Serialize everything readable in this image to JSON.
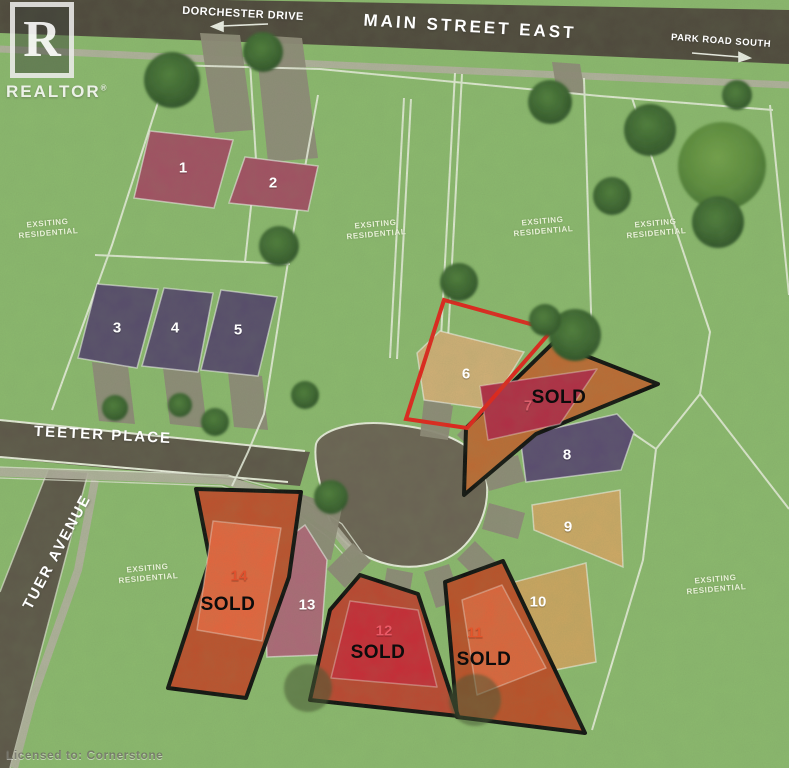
{
  "branding": {
    "logo_letter": "R",
    "logo_name": "REALTOR",
    "registered_symbol": "®",
    "license_watermark": "Licensed to: Cornerstone"
  },
  "streets": {
    "dorchester": {
      "label": "DORCHESTER DRIVE",
      "arrow": "left"
    },
    "main_street": {
      "label": "MAIN STREET EAST"
    },
    "park_road": {
      "label": "PARK ROAD SOUTH",
      "arrow": "right"
    },
    "teeter": {
      "label": "TEETER PLACE"
    },
    "tuer": {
      "label": "TUER AVENUE"
    }
  },
  "area_label": "EXSITING RESIDENTIAL",
  "map_colors": {
    "grass": "#8dbb6f",
    "main_road": "#4e463c",
    "local_road": "#5d5549",
    "cul_de_sac": "#6b6154",
    "sidewalk": "#b7b3a4",
    "driveway": "#908a7a",
    "survey_line": "#f3f6e9",
    "selected_outline": "#e8201a",
    "sold_outline": "#0d0d0d"
  },
  "lots": [
    {
      "number": "1",
      "sold": false,
      "fill": "#a54e64",
      "number_color": "#ffffff"
    },
    {
      "number": "2",
      "sold": false,
      "fill": "#a54e64",
      "number_color": "#ffffff"
    },
    {
      "number": "3",
      "sold": false,
      "fill": "#574a6d",
      "number_color": "#ffffff"
    },
    {
      "number": "4",
      "sold": false,
      "fill": "#574a6d",
      "number_color": "#ffffff"
    },
    {
      "number": "5",
      "sold": false,
      "fill": "#574a6d",
      "number_color": "#ffffff"
    },
    {
      "number": "6",
      "sold": false,
      "fill": "#d4b178",
      "number_color": "#ffffff",
      "highlight": "#e8201a"
    },
    {
      "number": "7",
      "sold": true,
      "status": "SOLD",
      "fill": "#b52a45",
      "outer_fill": "#c06a33",
      "number_color": "#d95f6b"
    },
    {
      "number": "8",
      "sold": false,
      "fill": "#5a4a72",
      "number_color": "#ffffff"
    },
    {
      "number": "9",
      "sold": false,
      "fill": "#d2aa66",
      "number_color": "#ffffff"
    },
    {
      "number": "10",
      "sold": false,
      "fill": "#cfa761",
      "number_color": "#ffffff"
    },
    {
      "number": "11",
      "sold": true,
      "status": "SOLD",
      "fill": "#e2643c",
      "outer_fill": "#bf4f28",
      "number_color": "#e4562c"
    },
    {
      "number": "12",
      "sold": true,
      "status": "SOLD",
      "fill": "#cc2836",
      "outer_fill": "#bf4530",
      "number_color": "#ea5a66"
    },
    {
      "number": "13",
      "sold": false,
      "fill": "#b0687a",
      "number_color": "#ffffff"
    },
    {
      "number": "14",
      "sold": true,
      "status": "SOLD",
      "fill": "#e9643e",
      "outer_fill": "#c14f2c",
      "number_color": "#e0512e"
    }
  ]
}
